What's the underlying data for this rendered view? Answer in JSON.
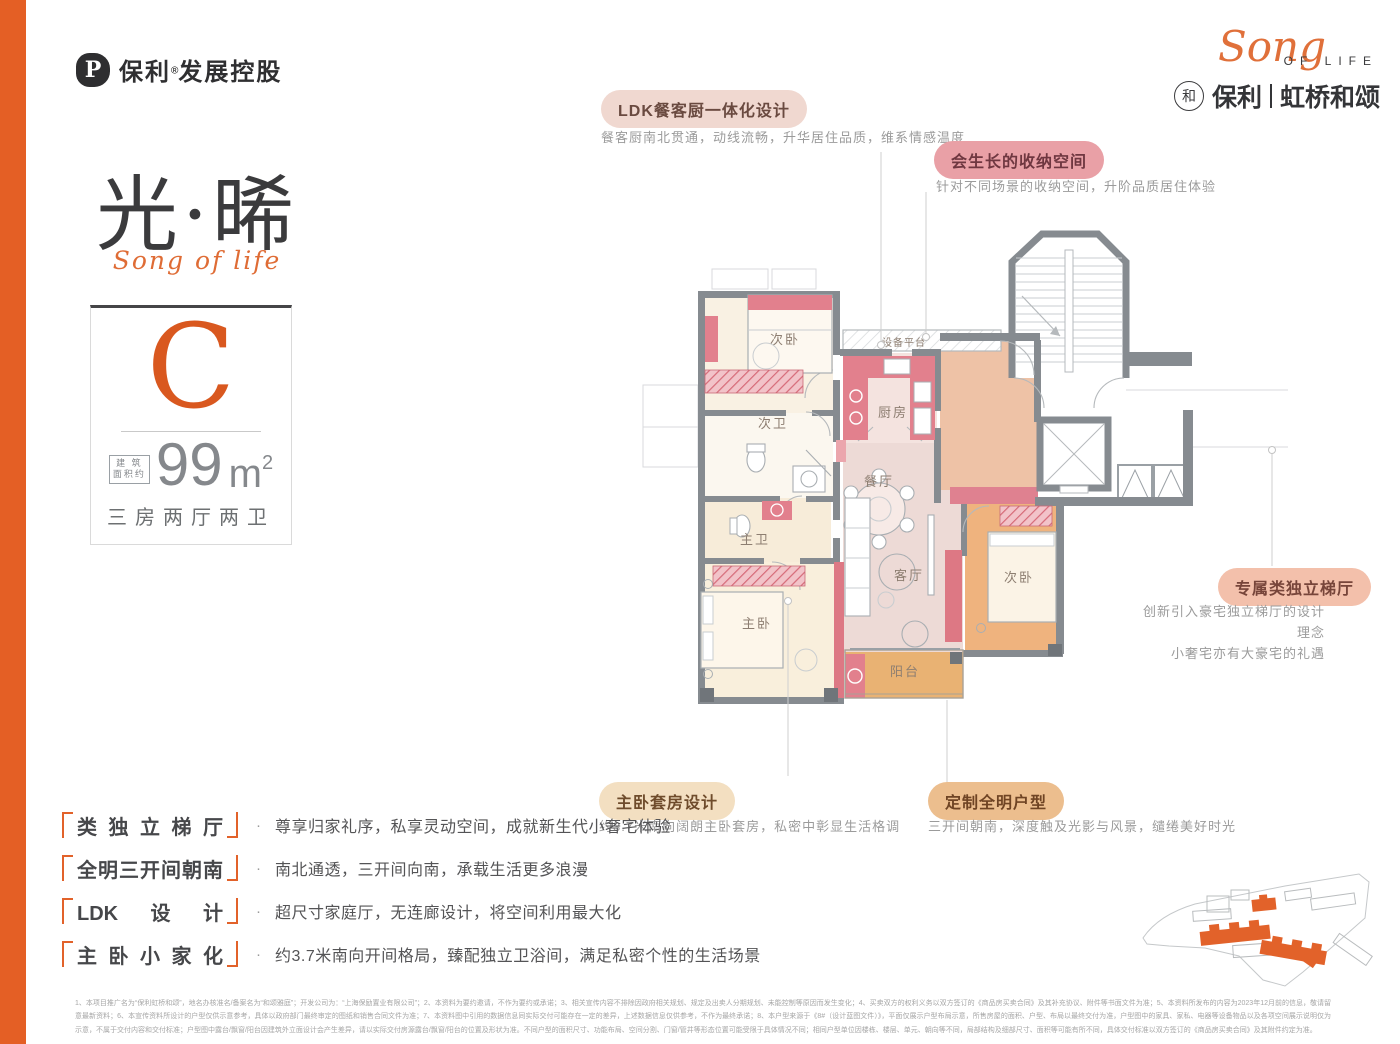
{
  "header": {
    "developer_name": "保利",
    "developer_reg": "®",
    "developer_suffix": "发展控股",
    "brand_script": "Song",
    "brand_script_sub": "OF LIFE",
    "brand_cn_left": "保利",
    "brand_cn_right": "虹桥和颂",
    "brand_circle_glyph": "和"
  },
  "hero": {
    "title_cn": "光·晞",
    "title_script": "Song of life",
    "plan_letter": "C",
    "area_prefix_line1": "建 筑",
    "area_prefix_line2": "面积约",
    "area_number": "99",
    "area_unit": "m",
    "area_power": "2",
    "rooms_summary": "三房两厅两卫"
  },
  "callouts": {
    "ldk": {
      "label": "LDK餐客厨一体化设计",
      "desc": "餐客厨南北贯通，动线流畅，升华居住品质，维系情感温度"
    },
    "storage": {
      "label": "会生长的收纳空间",
      "desc": "针对不同场景的收纳空间，升阶品质居住体验"
    },
    "lobby": {
      "label": "专属类独立梯厅",
      "desc1": "创新引入豪宅独立梯厅的设计理念",
      "desc2": "小奢宅亦有大豪宅的礼遇"
    },
    "suite": {
      "label": "主卧套房设计",
      "desc": "约3.7米南向阔朗主卧套房，私密中彰显生活格调"
    },
    "bright": {
      "label": "定制全明户型",
      "desc": "三开间朝南，深度触及光影与风景，缱绻美好时光"
    }
  },
  "floorplan": {
    "bedroom_top": "次卧",
    "bath_second": "次卫",
    "bath_master": "主卫",
    "bedroom_master": "主卧",
    "kitchen": "厨房",
    "equipment_platform": "设备平台",
    "dining": "餐厅",
    "living": "客厅",
    "bedroom_third": "次卧",
    "balcony": "阳台"
  },
  "features": [
    {
      "title": "类独立梯厅",
      "desc": "尊享归家礼序，私享灵动空间，成就新生代小奢宅体验"
    },
    {
      "title": "全明三开间朝南",
      "desc": "南北通透，三开间向南，承载生活更多浪漫"
    },
    {
      "title": "LDK设计",
      "desc": "超尺寸家庭厅，无连廊设计，将空间利用最大化"
    },
    {
      "title": "主卧小家化",
      "desc": "约3.7米南向开间格局，臻配独立卫浴间，满足私密个性的生活场景"
    }
  ],
  "colors": {
    "accent_orange": "#e2622a",
    "band_orange": "#e45f25",
    "wall_gray": "#868b90",
    "accent_pink": "#e2808d",
    "room_cream": "#f9f1e3",
    "room_dusty_pink": "#eddad6",
    "room_salmon": "#eec2a6",
    "room_orange": "#efb37e",
    "balcony_orange": "#e9b273"
  },
  "disclaimer": "1、本项目推广名为“保利虹桥和颂”，地名办核准名/备案名为“和颂雅庭”；开发公司为：“上海保励置业有限公司”；2、本资料为要约邀请，不作为要约或承诺；3、相关宣传内容不排除因政府相关规划、规定及出卖人分期规划、未能控制等原因而发生变化；4、买卖双方的权利义务以双方签订的《商品房买卖合同》及其补充协议、附件等书面文件为准；5、本资料所发布的内容为2023年12月前的信息，敬请留意最新资料；6、本宣传资料所设计的户型仅供示意参考，具体以政府部门最终审定的图纸和销售合同文件为准；7、本资料图中引用的数据信息同实际交付可能存在一定的差异，上述数据信息仅供参考，不作为最终承诺；8、本户型来源于《8#（设计蓝图文件）》，平面仅展示户型布局示意，所售房屋的面积、户型、布局以最终交付为准，户型图中的家具、家私、电器等设备物品以及各项空间展示说明仅为示意，不属于交付内容和交付标准；户型图中露台/飘窗/阳台因建筑外立面设计会产生差异，请以实际交付房源露台/飘窗/阳台的位置及形状为准。不同户型的面积尺寸、功能布局、空间分割、门窗/管井等形态位置可能受限于具体情况不同；相同户型单位因楼栋、楼层、单元、朝向等不同，局部结构及细部尺寸、面积等可能有所不同，具体交付标准以双方签订的《商品房买卖合同》及其附件约定为准。"
}
